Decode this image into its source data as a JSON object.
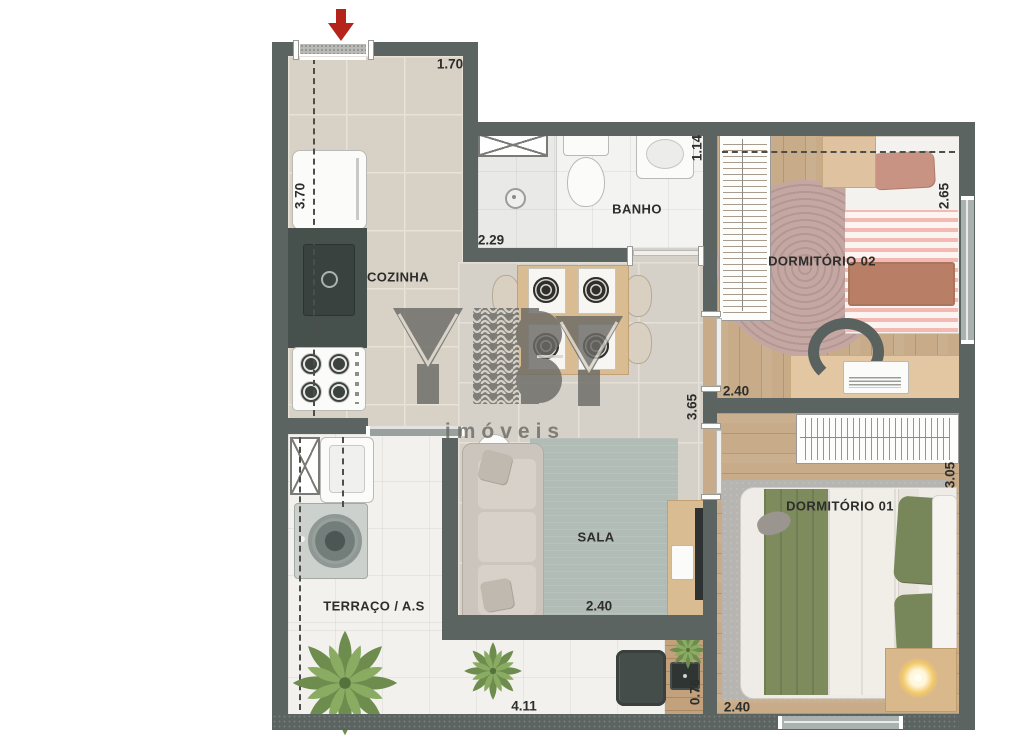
{
  "plan_title": "apartment-floor-plan",
  "watermark": {
    "brand": "YBY",
    "subtitle": "imóveis"
  },
  "rooms": {
    "cozinha": {
      "label": "COZINHA"
    },
    "banho": {
      "label": "BANHO"
    },
    "sala": {
      "label": "SALA"
    },
    "terraco": {
      "label": "TERRAÇO / A.S"
    },
    "dorm02": {
      "label": "DORMITÓRIO 02"
    },
    "dorm01": {
      "label": "DORMITÓRIO 01"
    }
  },
  "dimensions": {
    "kitchen_top": "1.70",
    "kitchen_left": "3.70",
    "kitchen_bath": "2.29",
    "bath_right": "1.14",
    "dorm02_right": "2.65",
    "dorm02_bottom": "2.40",
    "sala_right": "3.65",
    "dorm01_right": "3.05",
    "sala_bottom": "2.40",
    "terrace_bottom": "4.11",
    "deck_width": "0.76",
    "dorm01_bottom": "2.40"
  },
  "colors": {
    "wall": "#5b6461",
    "entrance_arrow": "#b5241b",
    "wood_floor": "#c8ab89",
    "kitchen_floor": "#d8d1c5",
    "bath_floor": "#f3f3f2",
    "sala_rug": "#b2bcb6",
    "dorm02_rug": "#c4a6a3",
    "bed_green": "#7e8b5d",
    "bed_pink_stripe": "#f6c6bf"
  }
}
